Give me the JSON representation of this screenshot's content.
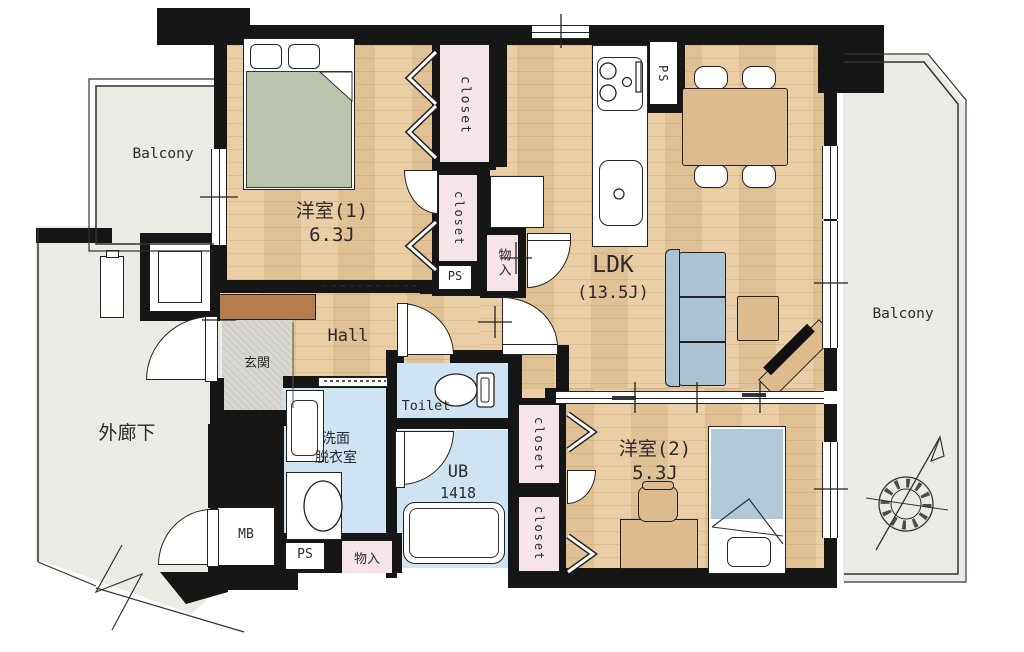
{
  "colors": {
    "wall": "#161616",
    "wood": "#e9c99b",
    "pink": "#f5e4e8",
    "wet": "#cfe4f2",
    "balcony": "#eceae4",
    "entrance-tile": "#d9d8d3",
    "cabinet-brown": "#b57f4b",
    "bed-green": "#bac4ad",
    "furniture-tan": "#debb8e",
    "sofa-blue": "#a9c2d4",
    "bed-blue": "#b0c8d8",
    "text": "#2b2b2b"
  },
  "rooms": {
    "bedroom1": {
      "name": "洋室(1)",
      "size": "6.3J"
    },
    "bedroom2": {
      "name": "洋室(2)",
      "size": "5.3J"
    },
    "ldk": {
      "name": "LDK",
      "size": "(13.5J)"
    },
    "hall": {
      "name": "Hall"
    },
    "entrance": {
      "name": "玄関"
    },
    "corridor": {
      "name": "外廊下"
    },
    "balcony_left": {
      "name": "Balcony"
    },
    "balcony_right": {
      "name": "Balcony"
    },
    "toilet": {
      "name": "Toilet"
    },
    "washroom": {
      "name_line1": "洗面",
      "name_line2": "脱衣室"
    },
    "bath": {
      "name": "UB",
      "size": "1418"
    }
  },
  "storage": {
    "closet1": {
      "name": "closet"
    },
    "closet2": {
      "name": "closet"
    },
    "closet3": {
      "name": "closet"
    },
    "closet4": {
      "name": "closet"
    },
    "storage_upper": {
      "name": "物入"
    },
    "storage_lower": {
      "name": "物入"
    }
  },
  "utility": {
    "ps_kitchen": {
      "name": "PS"
    },
    "ps_middle": {
      "name": "PS"
    },
    "ps_lower": {
      "name": "PS"
    },
    "meter_box": {
      "name": "MB"
    }
  }
}
